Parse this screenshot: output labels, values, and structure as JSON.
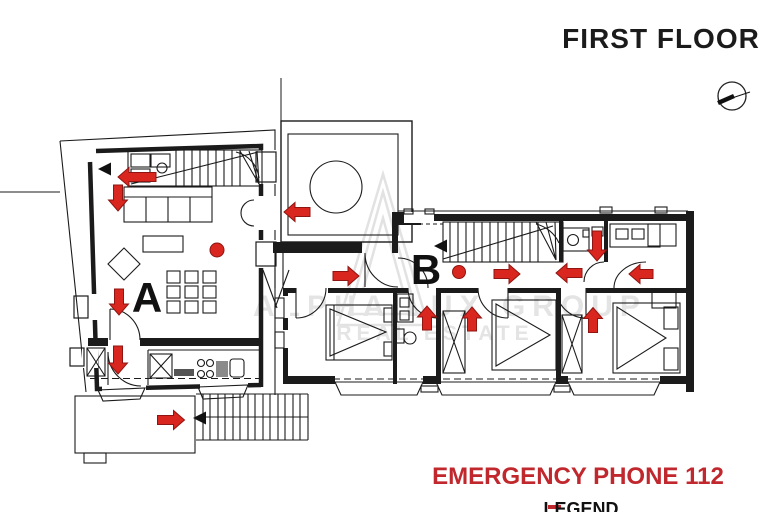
{
  "title": "FIRST FLOOR",
  "labels": {
    "zone_a": "A",
    "zone_b": "B"
  },
  "emergency": {
    "phone_text": "EMERGENCY PHONE 112"
  },
  "legend": {
    "heading": "LEGEND"
  },
  "watermark": {
    "line1": "ALPHA LUX GROUP",
    "line2": "REAL ESTATE"
  },
  "icons": {
    "north": "north-arrow-icon"
  },
  "colors": {
    "ink": "#1b1b1b",
    "evac_red": "#d9261f",
    "evac_red_dark": "#8e1511",
    "emergency_text_red": "#c0282e",
    "watermark_gray": "#e4e4e4"
  },
  "evacuation": {
    "arrows": [
      {
        "x": 137,
        "y": 177,
        "dir": "left",
        "len": 38
      },
      {
        "x": 118,
        "y": 198,
        "dir": "down",
        "len": 26
      },
      {
        "x": 119,
        "y": 302,
        "dir": "down",
        "len": 26
      },
      {
        "x": 118,
        "y": 360,
        "dir": "down",
        "len": 28
      },
      {
        "x": 171,
        "y": 420,
        "dir": "right",
        "len": 27
      },
      {
        "x": 297,
        "y": 212,
        "dir": "left",
        "len": 26
      },
      {
        "x": 346,
        "y": 276,
        "dir": "right",
        "len": 26
      },
      {
        "x": 507,
        "y": 274,
        "dir": "right",
        "len": 26
      },
      {
        "x": 569,
        "y": 273,
        "dir": "left",
        "len": 26
      },
      {
        "x": 641,
        "y": 274,
        "dir": "left",
        "len": 24
      },
      {
        "x": 597,
        "y": 246,
        "dir": "down",
        "len": 30
      },
      {
        "x": 427,
        "y": 318,
        "dir": "up",
        "len": 24
      },
      {
        "x": 472,
        "y": 319,
        "dir": "up",
        "len": 24
      },
      {
        "x": 593,
        "y": 320,
        "dir": "up",
        "len": 25
      }
    ],
    "dots": [
      {
        "x": 217,
        "y": 250,
        "r": 7
      },
      {
        "x": 459,
        "y": 272,
        "r": 6.5
      }
    ],
    "stair_markers": [
      {
        "x": 98,
        "y": 169,
        "dir": "left"
      },
      {
        "x": 193,
        "y": 418,
        "dir": "left"
      },
      {
        "x": 434,
        "y": 246,
        "dir": "left"
      }
    ]
  }
}
